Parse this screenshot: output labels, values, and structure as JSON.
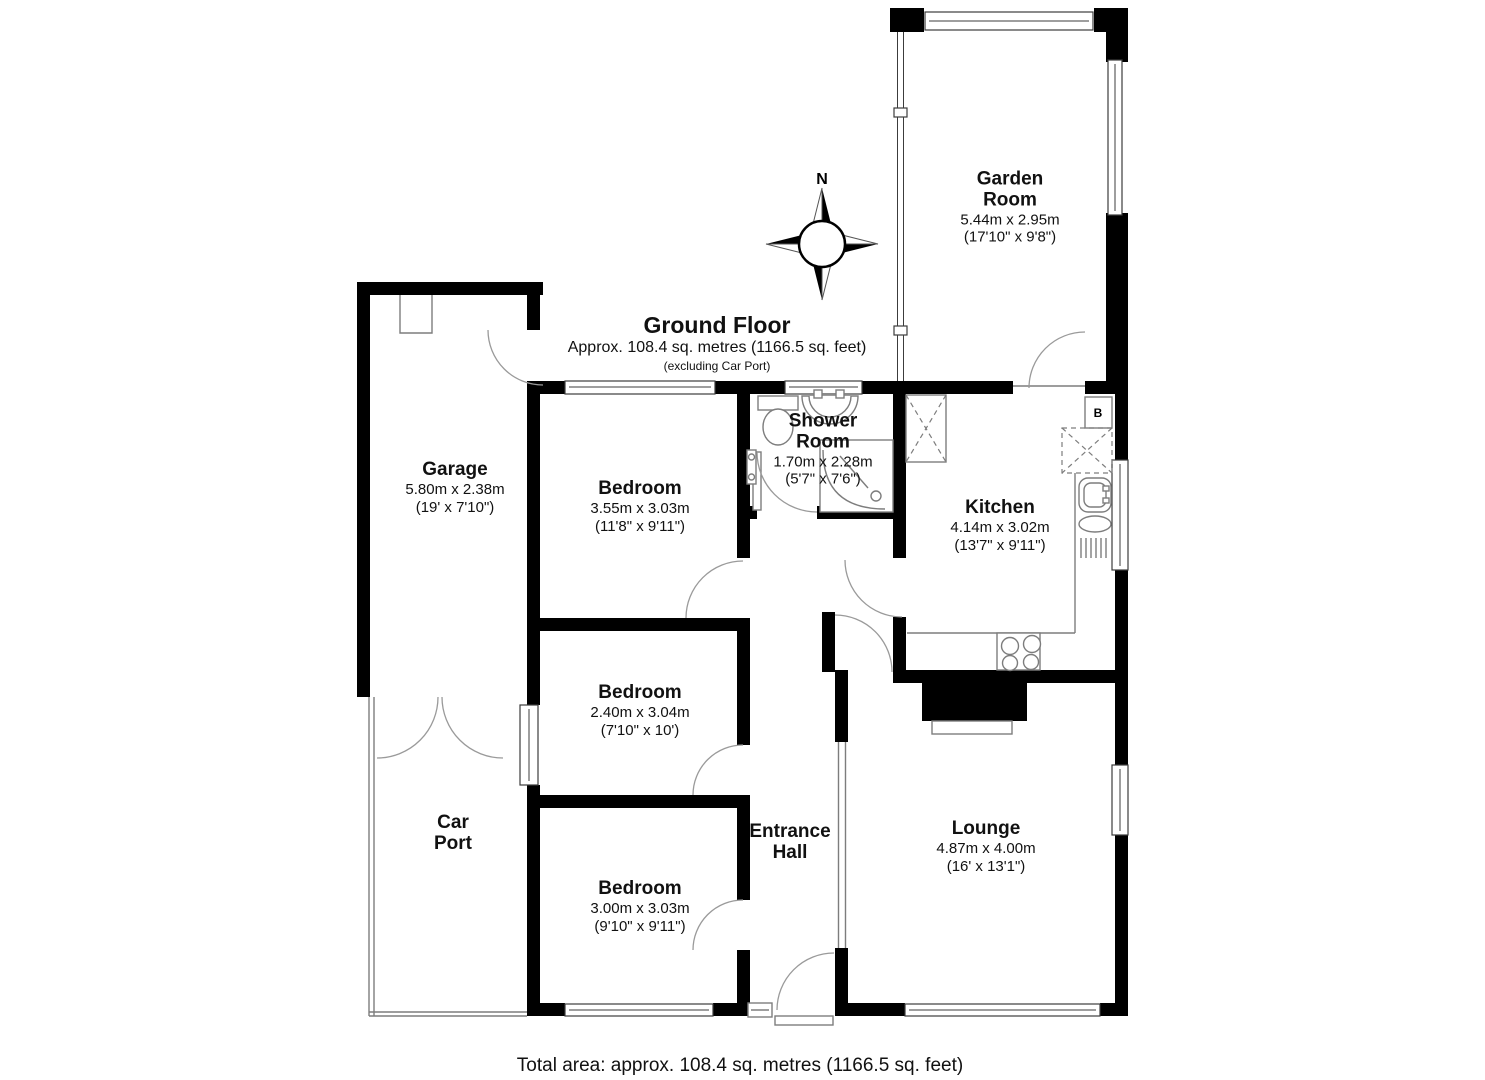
{
  "title": {
    "heading": "Ground Floor",
    "area": "Approx. 108.4 sq. metres (1166.5 sq. feet)",
    "note": "(excluding Car Port)"
  },
  "footer": {
    "total_area": "Total area: approx. 108.4 sq. metres (1166.5 sq. feet)"
  },
  "compass": {
    "label": "N"
  },
  "fixtures": {
    "boiler_label": "B"
  },
  "rooms": {
    "garden_room": {
      "name": "Garden Room",
      "metric": "5.44m x 2.95m",
      "imperial": "(17'10\" x 9'8\")"
    },
    "garage": {
      "name": "Garage",
      "metric": "5.80m x 2.38m",
      "imperial": "(19' x 7'10\")"
    },
    "bedroom1": {
      "name": "Bedroom",
      "metric": "3.55m x 3.03m",
      "imperial": "(11'8\" x 9'11\")"
    },
    "shower_room": {
      "name": "Shower Room",
      "metric": "1.70m x 2.28m",
      "imperial": "(5'7\" x 7'6\")"
    },
    "kitchen": {
      "name": "Kitchen",
      "metric": "4.14m x 3.02m",
      "imperial": "(13'7\" x 9'11\")"
    },
    "bedroom2": {
      "name": "Bedroom",
      "metric": "2.40m x 3.04m",
      "imperial": "(7'10\" x 10')"
    },
    "bedroom3": {
      "name": "Bedroom",
      "metric": "3.00m x 3.03m",
      "imperial": "(9'10\" x 9'11\")"
    },
    "car_port": {
      "name": "Car Port"
    },
    "entrance_hall": {
      "name": "Entrance Hall"
    },
    "lounge": {
      "name": "Lounge",
      "metric": "4.87m x 4.00m",
      "imperial": "(16' x 13'1\")"
    }
  },
  "colors": {
    "wall": "#000000",
    "line": "#7d7d7d",
    "arc": "#9a9a9a",
    "background": "#ffffff"
  }
}
